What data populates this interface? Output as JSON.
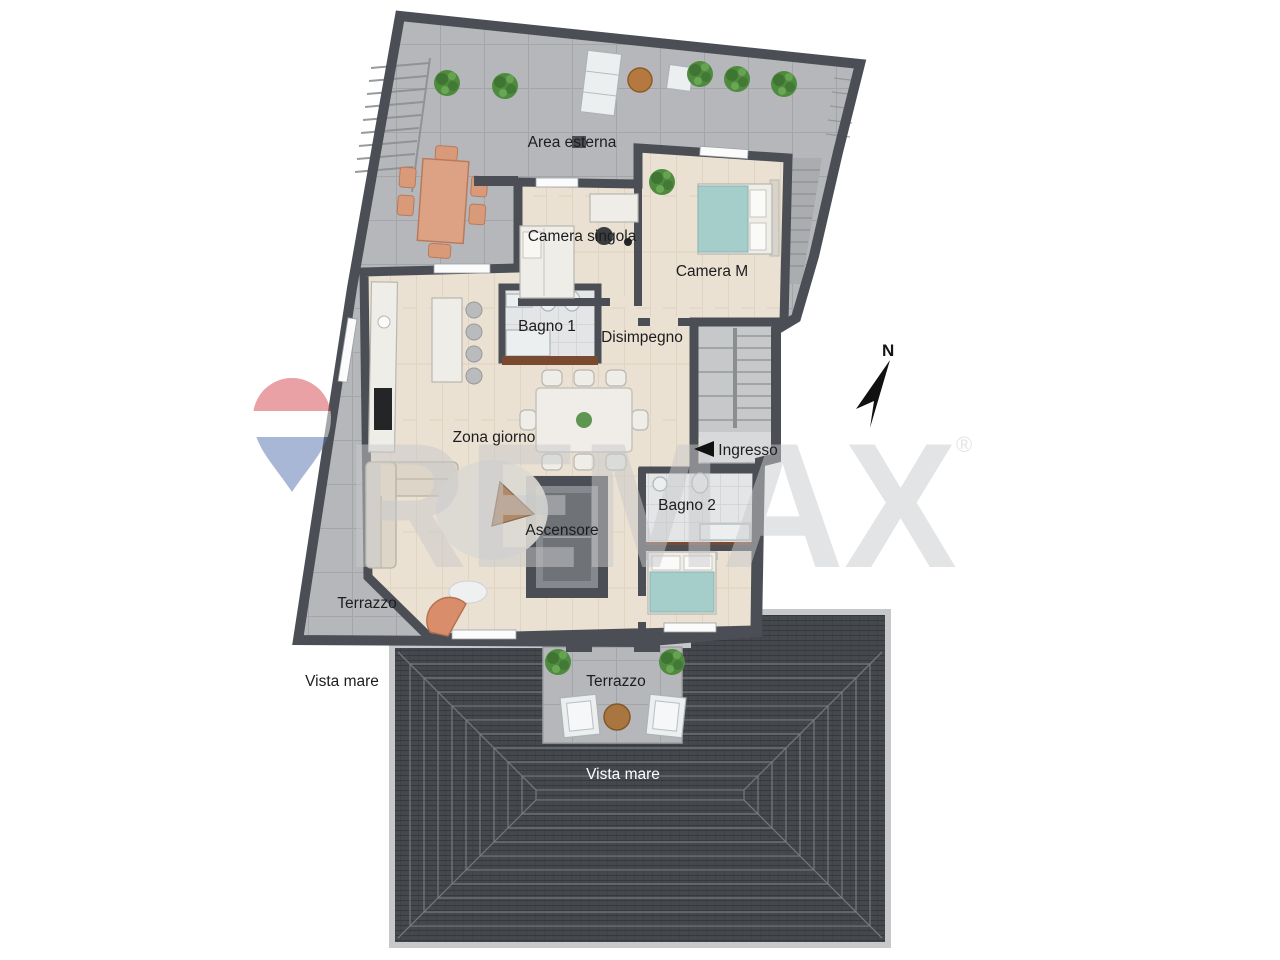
{
  "rooms": {
    "camera_singola": "Camera singola",
    "camera_m": "Camera M",
    "bagno_1": "Bagno 1",
    "disimpegno": "Disimpegno",
    "zona_giorno": "Zona giorno",
    "ingresso": "Ingresso",
    "bagno_2": "Bagno 2",
    "ascensore": "Ascensore"
  },
  "outdoor": {
    "area_esterna": "Area esterna",
    "terrazzo_west": "Terrazzo",
    "vista_mare_west": "Vista mare",
    "terrazzo_south": "Terrazzo",
    "vista_mare_south": "Vista mare"
  },
  "compass": {
    "north": "N"
  },
  "watermark": {
    "brand": "REMAX",
    "registered": "®"
  },
  "colors": {
    "wall": "#4b4f55",
    "terrace": "#b5b7ba",
    "terraceLine": "#a3a5a8",
    "wood": "#eae1d2",
    "woodLine": "#ddd1bf",
    "bath": "#e4e5e6",
    "bathLine": "#d5d6d8",
    "roof": "#45484d",
    "roofLine": "#36393d",
    "roofRing": "#7a7e83",
    "roofRim": "#c7c8ca",
    "stair": "#c6c8ca",
    "stairLand": "#d8d9db",
    "shaft": "#85898d",
    "shaftDark": "#6f7377",
    "brown": "#7a4a30",
    "teal": "#a5cdc9",
    "terracotta": "#d99a79",
    "plant": "#4e8b3f",
    "plantDark": "#35672b",
    "label": "#1d1d1f",
    "labelWhite": "#ffffff",
    "watermark": "#c9cacc",
    "balloonRed": "#d64550",
    "balloonBlue": "#5671ae"
  }
}
